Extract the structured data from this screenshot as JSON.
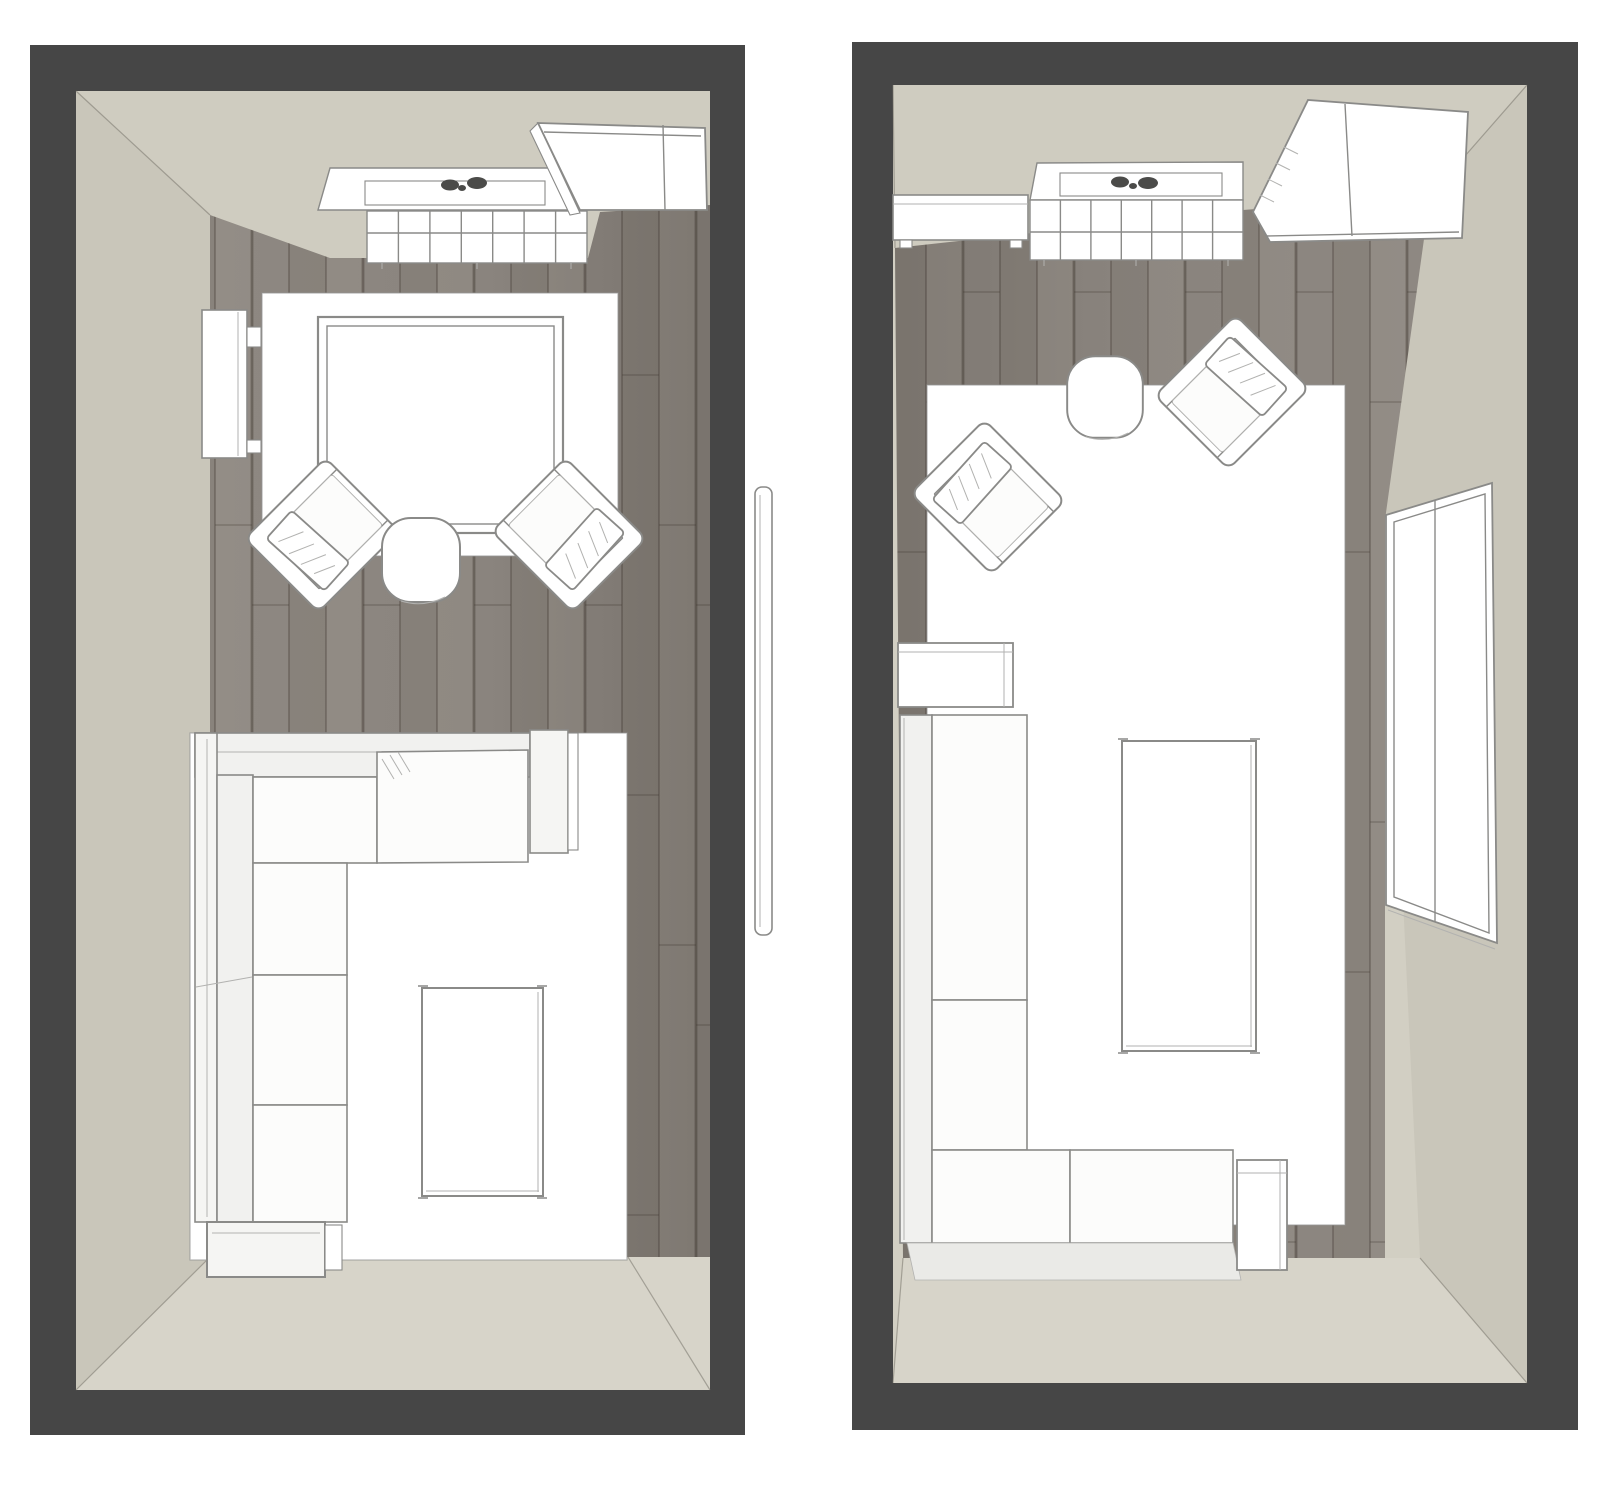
{
  "meta": {
    "description": "Side-by-side top-down 3D renders of two furnished living-room layout variants",
    "render_type": "floor-plan-3d-top-view",
    "room_count": 2,
    "visible_text": ""
  },
  "colors": {
    "page": "#ffffff",
    "frame": "#464646",
    "wall": "#d2cfc3",
    "wallTop": "#cfccc0",
    "wallSide": "#c9c6ba",
    "wallFloor": "#d7d4c9",
    "woodA": "#8e8882",
    "woodB": "#89837c",
    "woodC": "#938d86",
    "woodLine": "rgba(72,64,56,0.5)",
    "line": "#8a8a88",
    "lineLight": "#b2b2b0",
    "miter": "rgba(120,116,108,0.55)",
    "white": "#ffffff",
    "seat": "#fcfcfb",
    "band": "#f1f1ef",
    "armFill": "#f5f5f3",
    "shadow": "#eaeae7",
    "rugStroke": "rgba(150,150,148,0.7)",
    "dark": "#4b4b49"
  },
  "rooms": [
    {
      "id": "room-left",
      "position": "left",
      "floor": "dark-wood-planks",
      "furniture": [
        "window-with-sill",
        "window-plants",
        "radiator",
        "sideboard-top-right",
        "wall-console",
        "seating-rug",
        "square-table",
        "armchair",
        "armchair",
        "round-side-table",
        "sectional-sofa-l-shape",
        "sofa-rug",
        "coffee-table"
      ]
    },
    {
      "id": "room-right",
      "position": "right",
      "floor": "dark-wood-planks",
      "furniture": [
        "sideboard-top-left",
        "window-with-sill",
        "window-plants",
        "radiator",
        "wardrobe-top-right",
        "large-rug",
        "armchair",
        "armchair",
        "round-side-table",
        "side-cabinet",
        "sectional-sofa-l-shape",
        "coffee-table",
        "cube-side-table",
        "tall-window-right-wall"
      ]
    }
  ],
  "between_rooms": {
    "item": "door-panel-leaning-in-gap"
  }
}
